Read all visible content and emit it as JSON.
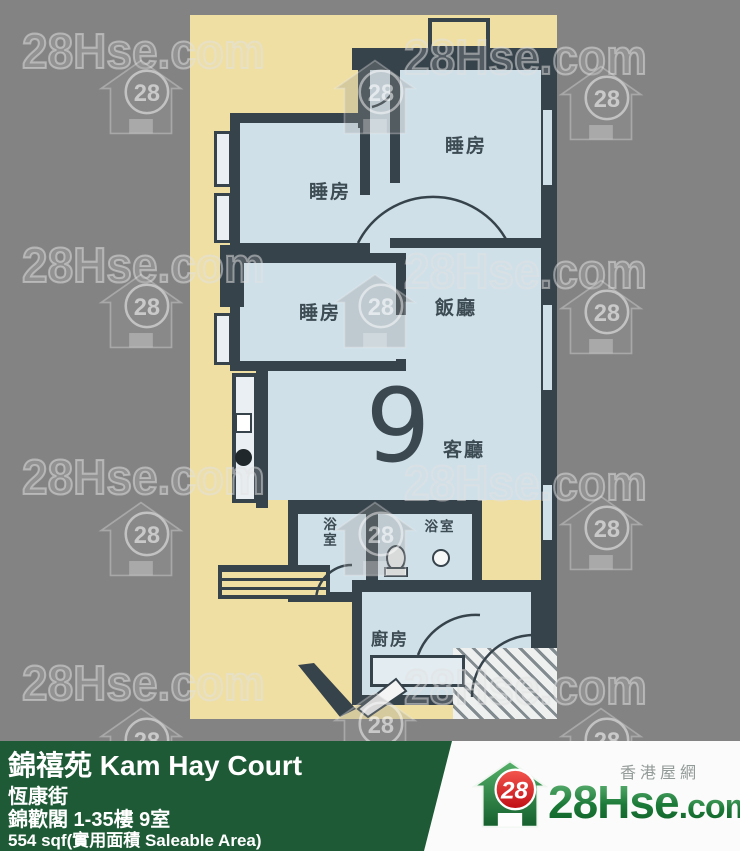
{
  "watermark": {
    "text": "28Hse.com",
    "badge": "28"
  },
  "plan": {
    "unit_number": "9",
    "labels": {
      "bedroom": "睡房",
      "dining": "飯廳",
      "living": "客廳",
      "kitchen": "廚房",
      "bath": "浴室"
    }
  },
  "info_bar": {
    "title": "錦禧苑 Kam Hay Court",
    "street": "恆康街",
    "block": "錦歡閣 1-35樓 9室",
    "area": "554 sqf(實用面積 Saleable Area)"
  },
  "branding": {
    "site_cn": "香港屋網",
    "site_main": "28Hse",
    "site_tld": ".com",
    "badge": "28"
  },
  "colors": {
    "page_bg": "#838383",
    "plan_bg": "#efdfa2",
    "room_fill": "#cfe0e9",
    "wall": "#37434b",
    "green_bar": "#1d5a35",
    "brand_green": "#1c7a38",
    "badge_red": "#d81118"
  }
}
